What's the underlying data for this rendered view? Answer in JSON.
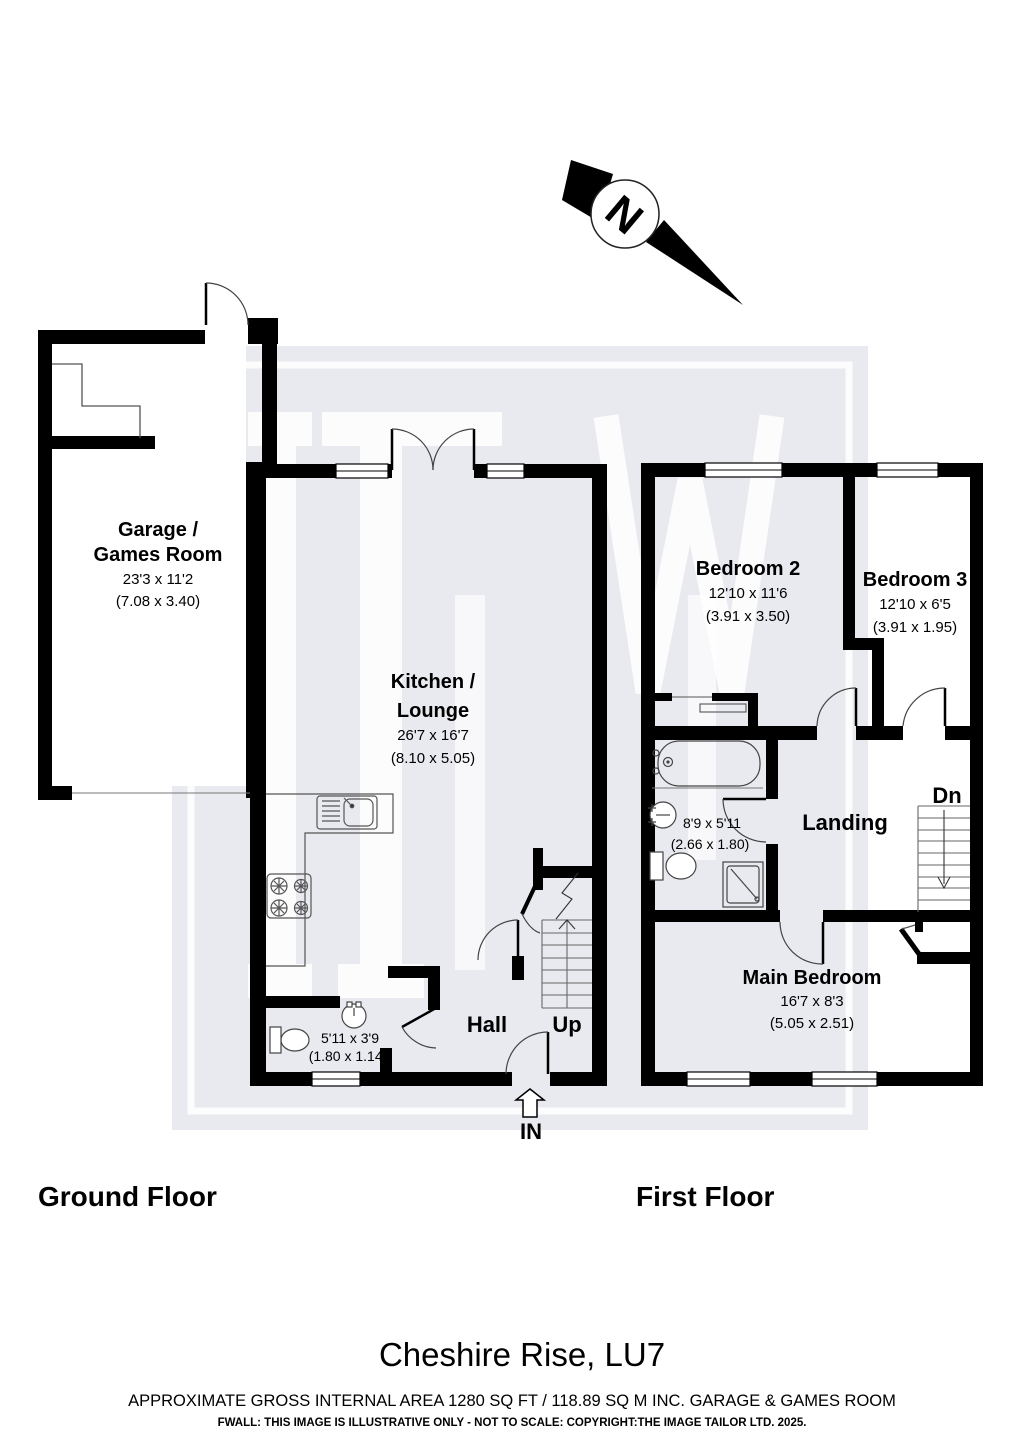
{
  "north_label": "N",
  "watermark_letters": "ITW",
  "ground_floor": {
    "title": "Ground Floor",
    "rooms": {
      "garage": {
        "name_line1": "Garage /",
        "name_line2": "Games Room",
        "dims_imperial": "23'3 x 11'2",
        "dims_metric": "(7.08 x 3.40)"
      },
      "kitchen_lounge": {
        "name_line1": "Kitchen /",
        "name_line2": "Lounge",
        "dims_imperial": "26'7 x 16'7",
        "dims_metric": "(8.10 x 5.05)"
      },
      "wc": {
        "dims_imperial": "5'11 x 3'9",
        "dims_metric": "(1.80 x 1.14)"
      },
      "hall": {
        "name": "Hall"
      }
    },
    "labels": {
      "up": "Up",
      "in": "IN"
    }
  },
  "first_floor": {
    "title": "First Floor",
    "rooms": {
      "bedroom2": {
        "name": "Bedroom 2",
        "dims_imperial": "12'10 x 11'6",
        "dims_metric": "(3.91 x 3.50)"
      },
      "bedroom3": {
        "name": "Bedroom 3",
        "dims_imperial": "12'10 x 6'5",
        "dims_metric": "(3.91 x 1.95)"
      },
      "bathroom": {
        "dims_imperial": "8'9 x 5'11",
        "dims_metric": "(2.66 x 1.80)"
      },
      "landing": {
        "name": "Landing"
      },
      "main_bedroom": {
        "name": "Main Bedroom",
        "dims_imperial": "16'7 x 8'3",
        "dims_metric": "(5.05 x 2.51)"
      }
    },
    "labels": {
      "dn": "Dn"
    }
  },
  "footer": {
    "address": "Cheshire Rise, LU7",
    "area_line": "APPROXIMATE GROSS INTERNAL AREA 1280 SQ FT / 118.89 SQ M INC. GARAGE & GAMES ROOM",
    "disclaimer": "FWALL: THIS IMAGE IS ILLUSTRATIVE ONLY - NOT TO SCALE: COPYRIGHT:THE IMAGE TAILOR LTD. 2025."
  }
}
